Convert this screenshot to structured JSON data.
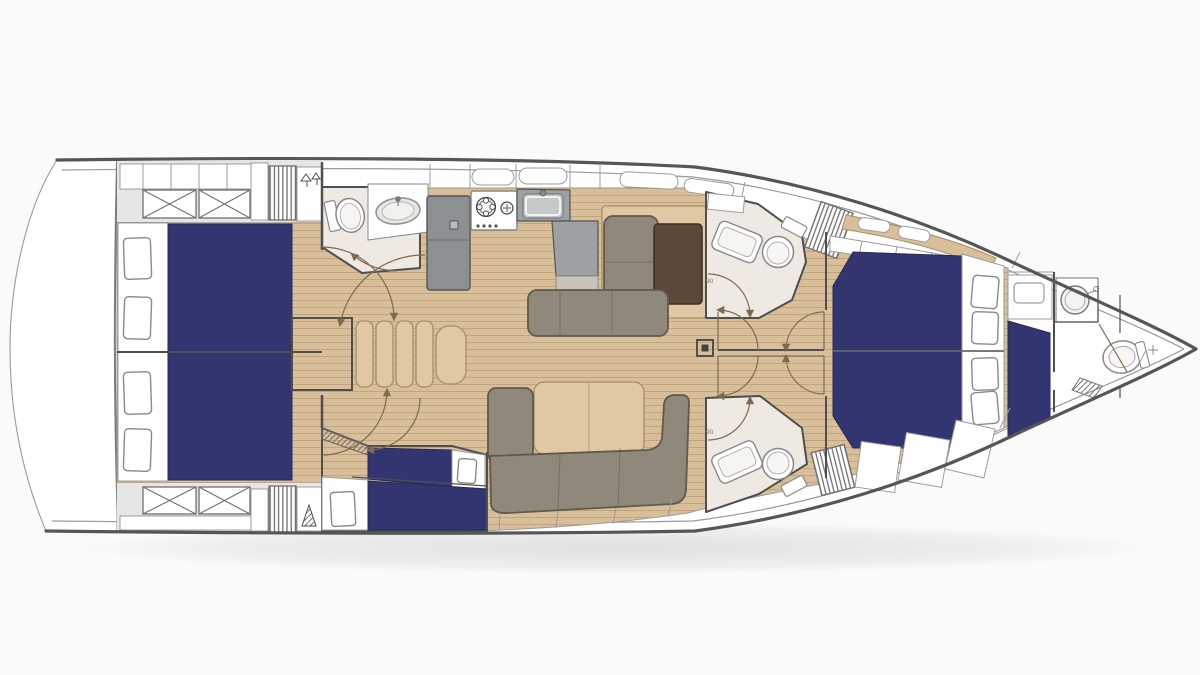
{
  "meta": {
    "title": "Sailing yacht interior layout plan",
    "type": "floor-plan",
    "orientation": "bow-right"
  },
  "colors": {
    "bg": "#fafafa",
    "hull_fill": "#ffffff",
    "hull_outline": "#565656",
    "hull_inner_line": "#9a9a9a",
    "wall": "#4f4f4f",
    "deck_strip": "#e6e6e6",
    "cabinet_white": "#ffffff",
    "cabinet_stroke": "#9c9c9c",
    "wood_floor": "#d8be99",
    "wood_plank_line": "#c2a57c",
    "wood_light": "#e0c8a2",
    "wood_trim": "#a88f63",
    "navy": "#32356f",
    "navy_outline": "#262a58",
    "sofa": "#90887a",
    "sofa_outline": "#5f594e",
    "table_dark": "#5b483a",
    "table_dark_outline": "#3b2f25",
    "bath_floor": "#efe9e3",
    "fixture_fill": "#ffffff",
    "fixture_stroke": "#888888",
    "counter_gray": "#9ea1a3",
    "appliance_gray": "#8d9093",
    "counter_outline": "#565656",
    "door_arc": "#7d6b4f",
    "hatch_line": "#6f6f6f",
    "pillow_outline": "#8a8a8a",
    "label": "#777777"
  },
  "annotations": {
    "door_swing_fwd_port_head": "90",
    "door_swing_fwd_stbd_head": "90"
  },
  "legend": {
    "rooms": [
      {
        "id": "swim-platform",
        "label": "Transom / swim platform"
      },
      {
        "id": "aft-cabin-port",
        "label": "Aft double cabin (port)"
      },
      {
        "id": "aft-cabin-starboard",
        "label": "Aft double cabin (starboard)"
      },
      {
        "id": "aft-head",
        "label": "Aft head with toilet and basin"
      },
      {
        "id": "galley",
        "label": "Galley with stove, sink and refrigerator"
      },
      {
        "id": "companionway",
        "label": "Companionway steps and landing"
      },
      {
        "id": "dinette",
        "label": "Raised dinette seat with table"
      },
      {
        "id": "salon",
        "label": "Salon sofa with table"
      },
      {
        "id": "bunk-cabin",
        "label": "Mid cabin with two berths"
      },
      {
        "id": "fwd-head-port",
        "label": "Forward head (port)"
      },
      {
        "id": "fwd-head-starboard",
        "label": "Forward head (starboard)"
      },
      {
        "id": "owners-cabin",
        "label": "Forward owner's cabin with double berth"
      },
      {
        "id": "bow-berth",
        "label": "Forepeak crew berth"
      },
      {
        "id": "bow-head",
        "label": "Forepeak head"
      },
      {
        "id": "mast",
        "label": "Mast post"
      }
    ]
  }
}
